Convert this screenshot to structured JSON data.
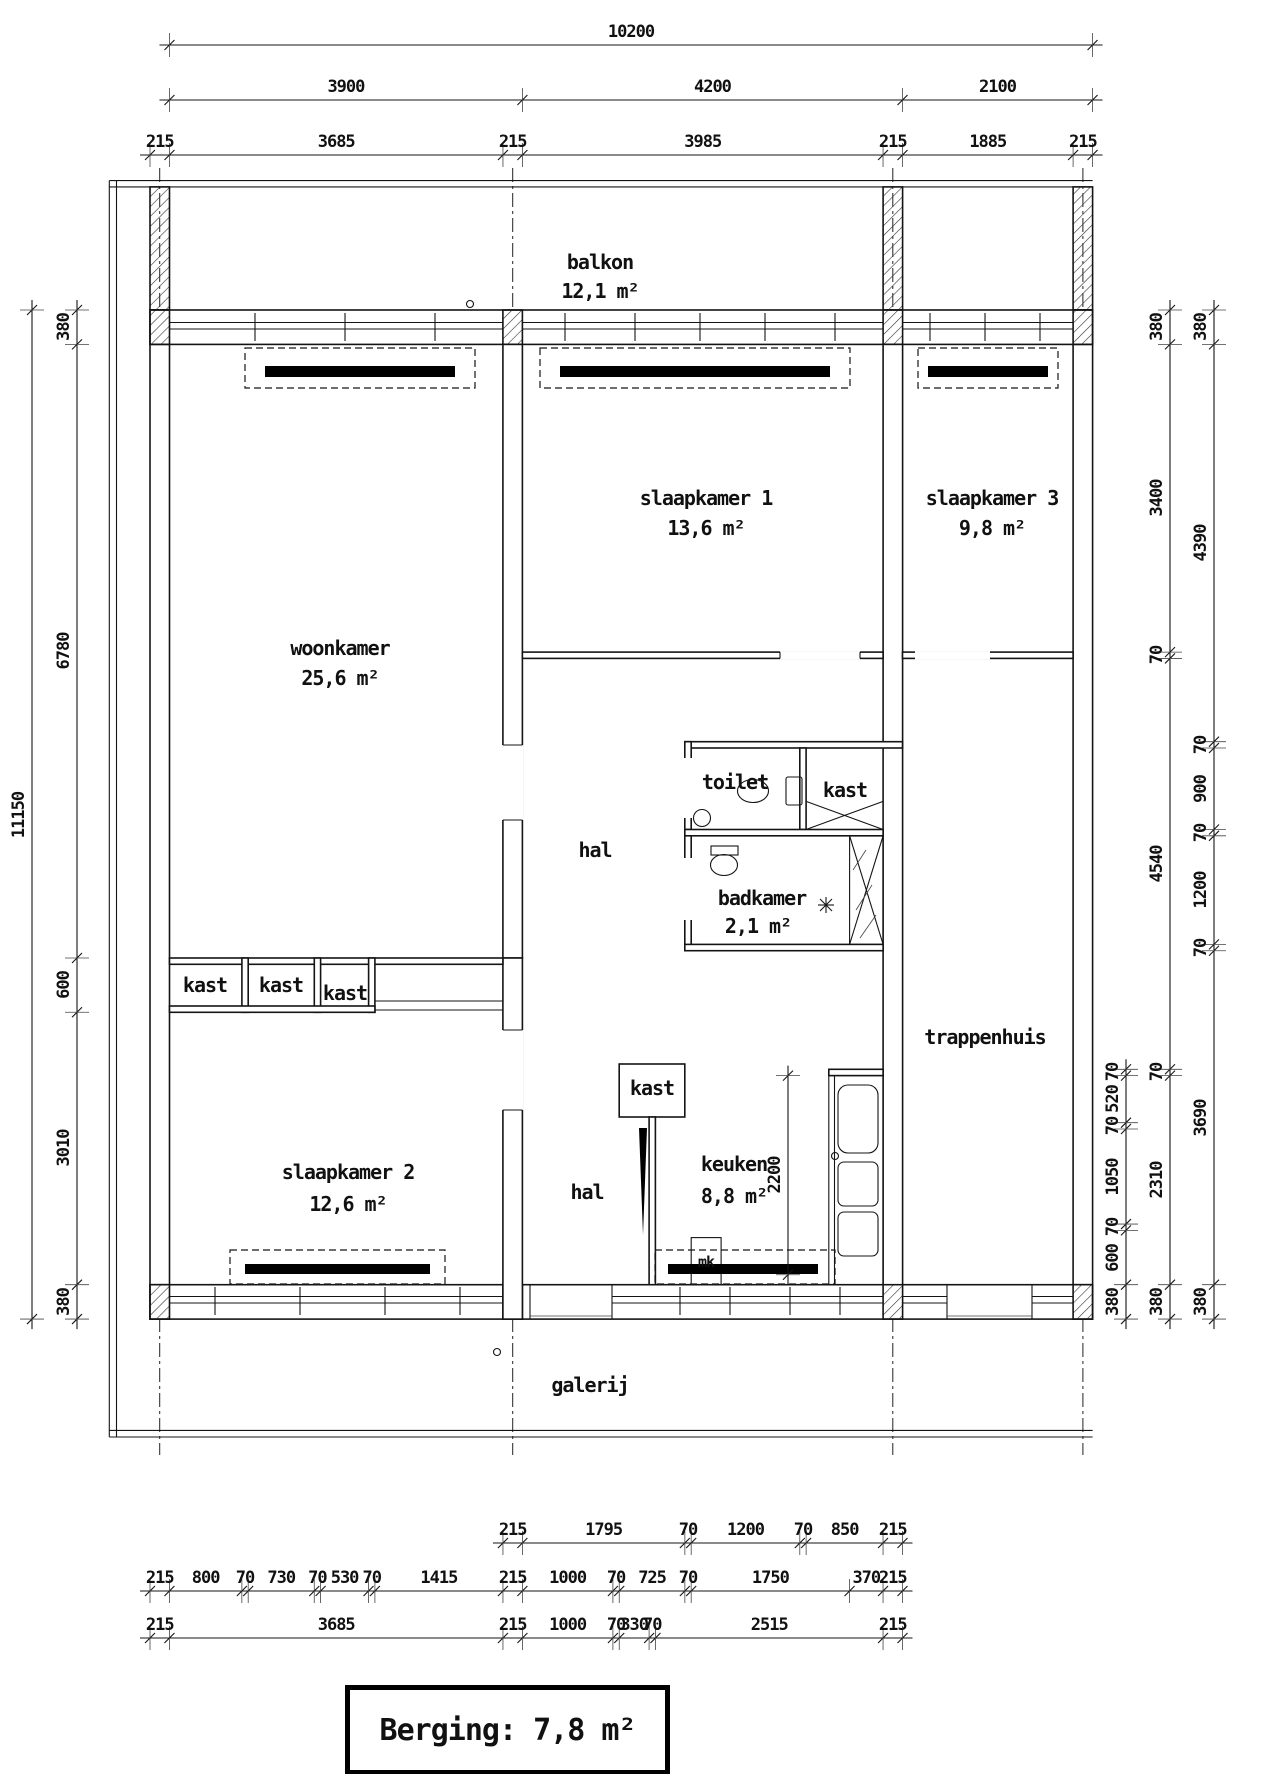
{
  "room_labels": [
    {
      "text": "balkon",
      "x": 600,
      "y": 262
    },
    {
      "text": "12,1 m²",
      "x": 600,
      "y": 291
    },
    {
      "text": "slaapkamer 1",
      "x": 706,
      "y": 498
    },
    {
      "text": "13,6 m²",
      "x": 706,
      "y": 528
    },
    {
      "text": "slaapkamer 3",
      "x": 992,
      "y": 498
    },
    {
      "text": "9,8 m²",
      "x": 992,
      "y": 528
    },
    {
      "text": "woonkamer",
      "x": 340,
      "y": 648
    },
    {
      "text": "25,6 m²",
      "x": 340,
      "y": 678
    },
    {
      "text": "hal",
      "x": 595,
      "y": 850
    },
    {
      "text": "toilet",
      "x": 735,
      "y": 782
    },
    {
      "text": "kast",
      "x": 845,
      "y": 790
    },
    {
      "text": "badkamer",
      "x": 762,
      "y": 898
    },
    {
      "text": "2,1 m²",
      "x": 758,
      "y": 926
    },
    {
      "text": "trappenhuis",
      "x": 985,
      "y": 1037
    },
    {
      "text": "kast",
      "x": 205,
      "y": 985
    },
    {
      "text": "kast",
      "x": 281,
      "y": 985
    },
    {
      "text": "kast",
      "x": 345,
      "y": 993
    },
    {
      "text": "kast",
      "x": 652,
      "y": 1088
    },
    {
      "text": "slaapkamer 2",
      "x": 348,
      "y": 1172
    },
    {
      "text": "12,6 m²",
      "x": 348,
      "y": 1204
    },
    {
      "text": "hal",
      "x": 587,
      "y": 1192
    },
    {
      "text": "keuken",
      "x": 734,
      "y": 1164
    },
    {
      "text": "8,8 m²",
      "x": 734,
      "y": 1196
    },
    {
      "text": "mk",
      "x": 706,
      "y": 1262,
      "small": true
    },
    {
      "text": "galerij",
      "x": 590,
      "y": 1385
    }
  ],
  "dim_chains": [
    {
      "dir": "h",
      "at": 45,
      "stations": [
        215,
        10415
      ],
      "labels": [
        "10200"
      ]
    },
    {
      "dir": "h",
      "at": 100,
      "stations": [
        215,
        4115,
        8315,
        10415
      ],
      "labels": [
        "3900",
        "4200",
        "2100"
      ]
    },
    {
      "dir": "h",
      "at": 155,
      "stations": [
        0,
        215,
        3900,
        4115,
        8100,
        8315,
        10200,
        10415
      ],
      "labels": [
        "215",
        "3685",
        "215",
        "3985",
        "215",
        "1885",
        "215"
      ]
    },
    {
      "dir": "v",
      "at": 32,
      "stations": [
        0,
        11150
      ],
      "labels": [
        "11150"
      ]
    },
    {
      "dir": "v",
      "at": 77,
      "stations": [
        0,
        380,
        7160,
        7760,
        10770,
        11150
      ],
      "labels": [
        "380",
        "6780",
        "600",
        "3010",
        "380"
      ]
    },
    {
      "dir": "v",
      "at": 1126,
      "stations": [
        8390,
        8460,
        8980,
        9050,
        10100,
        10170,
        10770,
        11150
      ],
      "labels": [
        "70",
        "520",
        "70",
        "1050",
        "70",
        "600",
        "380"
      ]
    },
    {
      "dir": "v",
      "at": 1170,
      "stations": [
        0,
        380,
        3780,
        3850,
        8390,
        8460,
        10770,
        11150
      ],
      "labels": [
        "380",
        "3400",
        "70",
        "4540",
        "70",
        "2310",
        "380"
      ]
    },
    {
      "dir": "v",
      "at": 1214,
      "stations": [
        0,
        380,
        4770,
        4840,
        5740,
        5810,
        7010,
        7080,
        10770,
        11150
      ],
      "labels": [
        "380",
        "4390",
        "70",
        "900",
        "70",
        "1200",
        "70",
        "3690",
        "380"
      ]
    },
    {
      "dir": "v",
      "at": 788,
      "stations": [
        8460,
        10660
      ],
      "labels": [
        "2200"
      ]
    },
    {
      "dir": "h",
      "at": 1543,
      "stations": [
        3900,
        4115,
        5910,
        5980,
        7180,
        7250,
        8100,
        8315
      ],
      "labels": [
        "215",
        "1795",
        "70",
        "1200",
        "70",
        "850",
        "215"
      ]
    },
    {
      "dir": "h",
      "at": 1591,
      "stations": [
        0,
        215,
        1015,
        1085,
        1815,
        1885,
        2415,
        2485,
        3900,
        4115,
        5115,
        5185,
        5910,
        5980,
        7730,
        8100,
        8315
      ],
      "labels": [
        "215",
        "800",
        "70",
        "730",
        "70",
        "530",
        "70",
        "1415",
        "215",
        "1000",
        "70",
        "725",
        "70",
        "1750",
        "370",
        "215"
      ]
    },
    {
      "dir": "h",
      "at": 1638,
      "stations": [
        0,
        215,
        3900,
        4115,
        5115,
        5185,
        5515,
        5585,
        8100,
        8315
      ],
      "labels": [
        "215",
        "3685",
        "215",
        "1000",
        "70",
        "330",
        "70",
        "2515",
        "215"
      ]
    }
  ],
  "berging": {
    "label": "Berging: 7,8 m²"
  }
}
